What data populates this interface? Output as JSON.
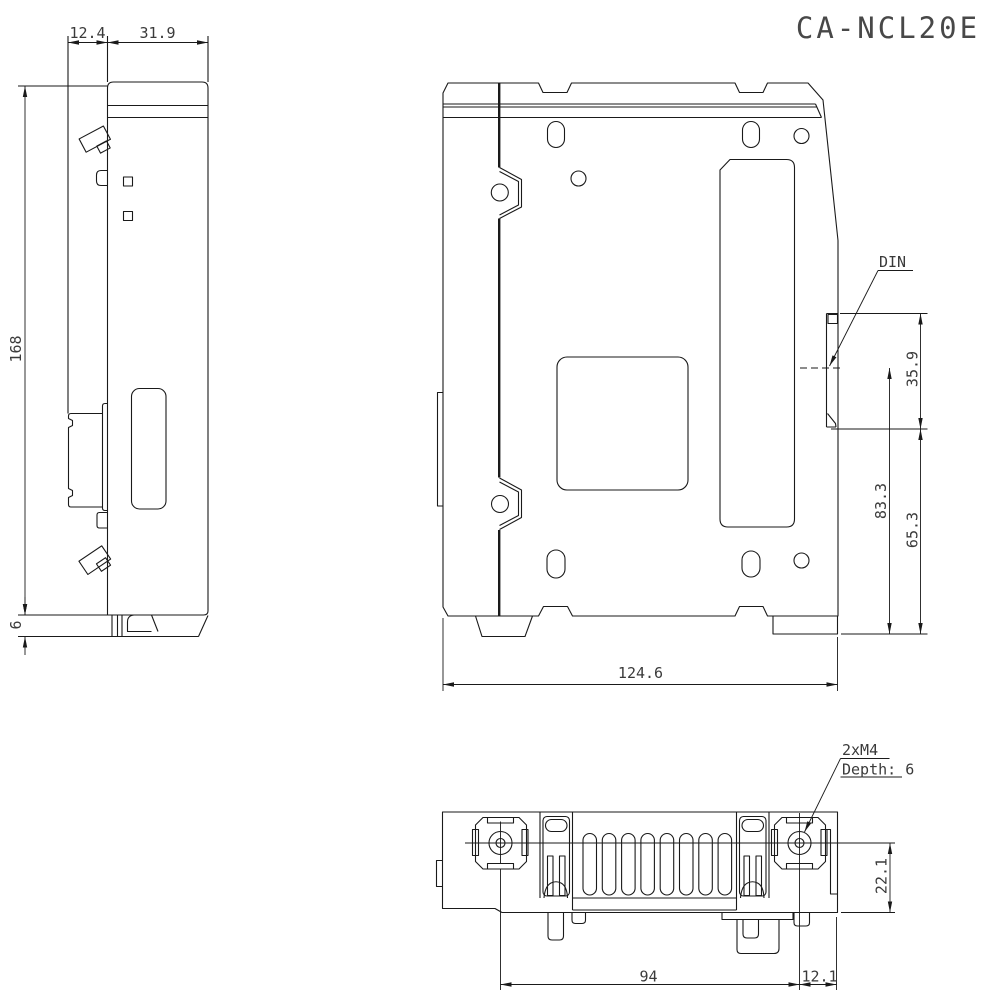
{
  "title": "CA-NCL20E",
  "colors": {
    "line": "#1a1a1a",
    "text": "#3a3a3a",
    "background": "#ffffff"
  },
  "side_view": {
    "dim_clip_width": "12.4",
    "dim_body_width": "31.9",
    "dim_height": "168",
    "dim_foot_height": "6"
  },
  "rear_view": {
    "din_label": "DIN",
    "dim_rail_height": "35.9",
    "dim_center_to_bottom": "83.3",
    "dim_rail_bottom_to_bottom": "65.3",
    "dim_width": "124.6"
  },
  "bottom_view": {
    "screw_note": "2xM4",
    "screw_depth_note": "Depth: 6",
    "dim_screw_to_rear": "22.1",
    "dim_screw_pitch": "94",
    "dim_screw_to_edge": "12.1"
  }
}
